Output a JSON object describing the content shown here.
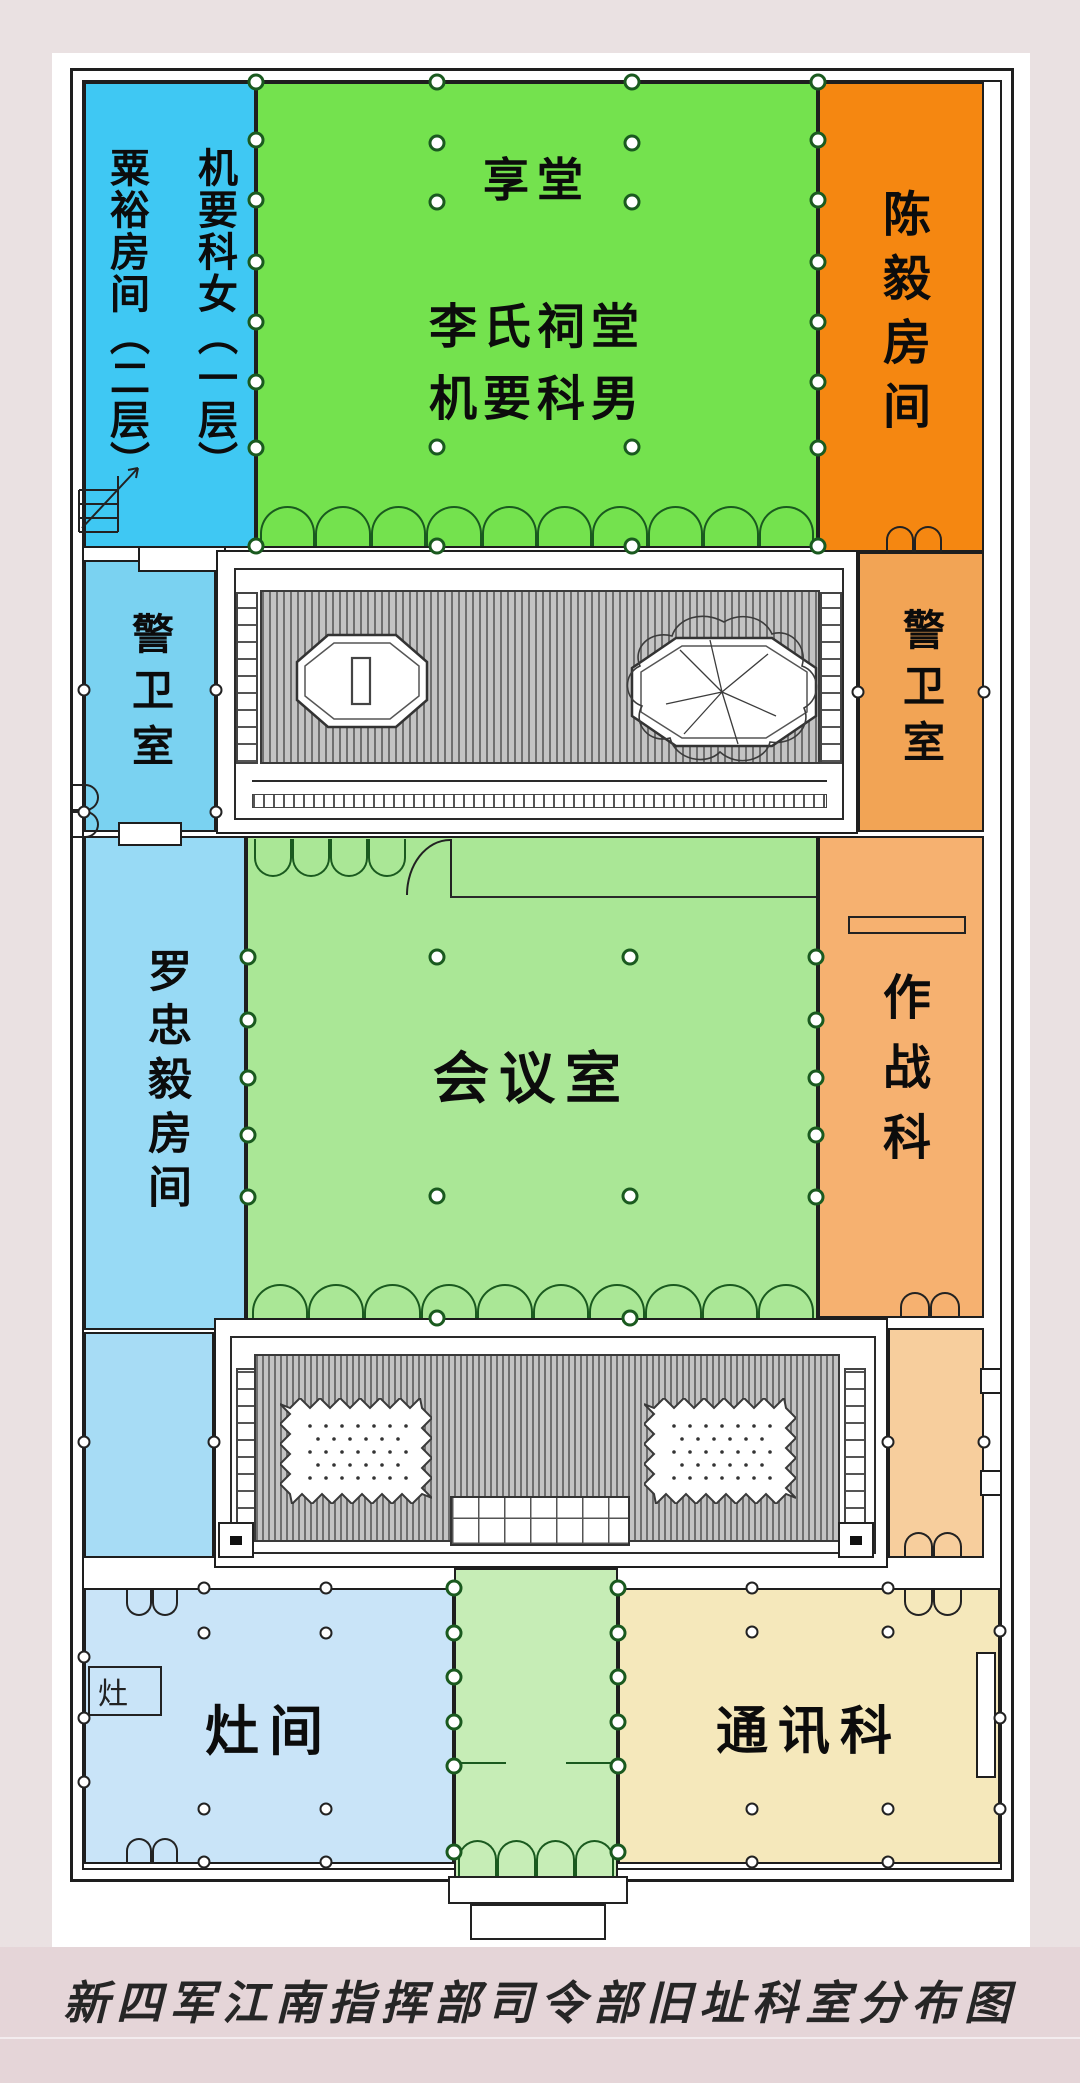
{
  "caption": "新四军江南指挥部司令部旧址科室分布图",
  "rooms": {
    "suyu": "粟裕房间（二层）",
    "jiyao_women": "机要科女（一层）",
    "xiangtang": "享堂",
    "citang": "李氏祠堂",
    "jiyao_men": "机要科男",
    "chenyi": "陈毅房间",
    "guard_left": "警卫室",
    "guard_right": "警卫室",
    "luozhongyi": "罗忠毅房间",
    "meeting": "会议室",
    "operations": "作战科",
    "kitchen": "灶间",
    "stove": "灶",
    "comms": "通讯科"
  },
  "colors": {
    "page_bg": "#EAE1E2",
    "caption_bg": "#E5D5D8",
    "sheet": "#FFFFFF",
    "wall": "#1E1E1E",
    "suyu_blue": "#3FC8F3",
    "guard_blue": "#7AD2F1",
    "luo_blue": "#98DAF5",
    "annex_blue": "#A7DCF5",
    "kitchen_blue": "#C9E4F8",
    "hall_green": "#74E24E",
    "meeting_green": "#AAE796",
    "south_green": "#C6EDB6",
    "chenyi_orange": "#F58711",
    "guard_orange": "#F2A455",
    "operations_orange": "#F6B170",
    "annex_peach": "#F7CE9D",
    "comms_tan": "#F5E8BB",
    "arc_green": "#1A5A1F"
  }
}
